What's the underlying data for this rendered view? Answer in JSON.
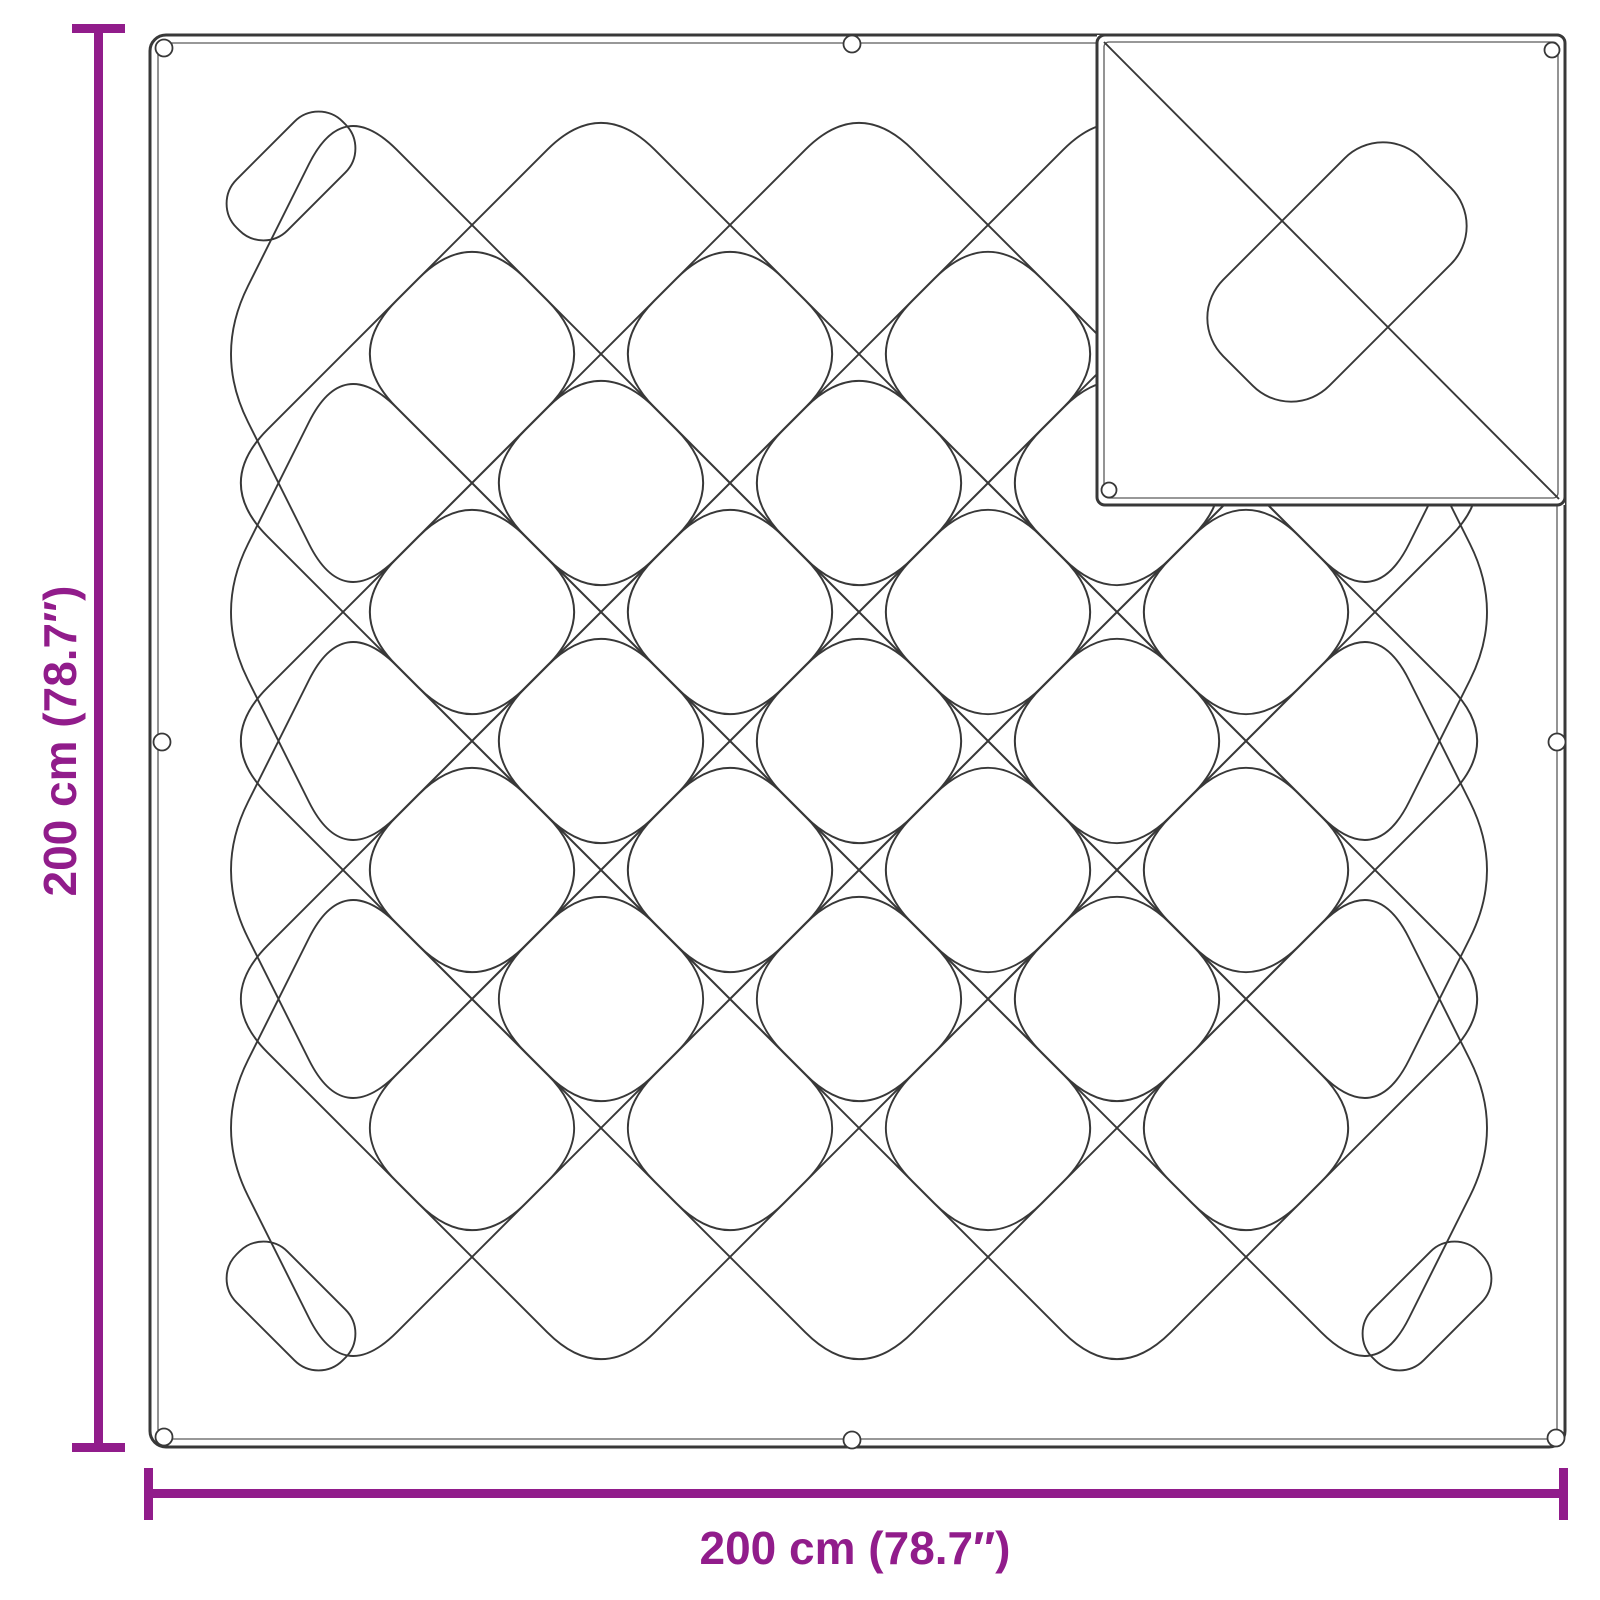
{
  "dimensions": {
    "height_label": "200 cm (78.7″)",
    "width_label": "200 cm (78.7″)"
  },
  "colors": {
    "dimension_accent": "#911C8B",
    "outline": "#383838",
    "background": "#FFFFFF"
  }
}
